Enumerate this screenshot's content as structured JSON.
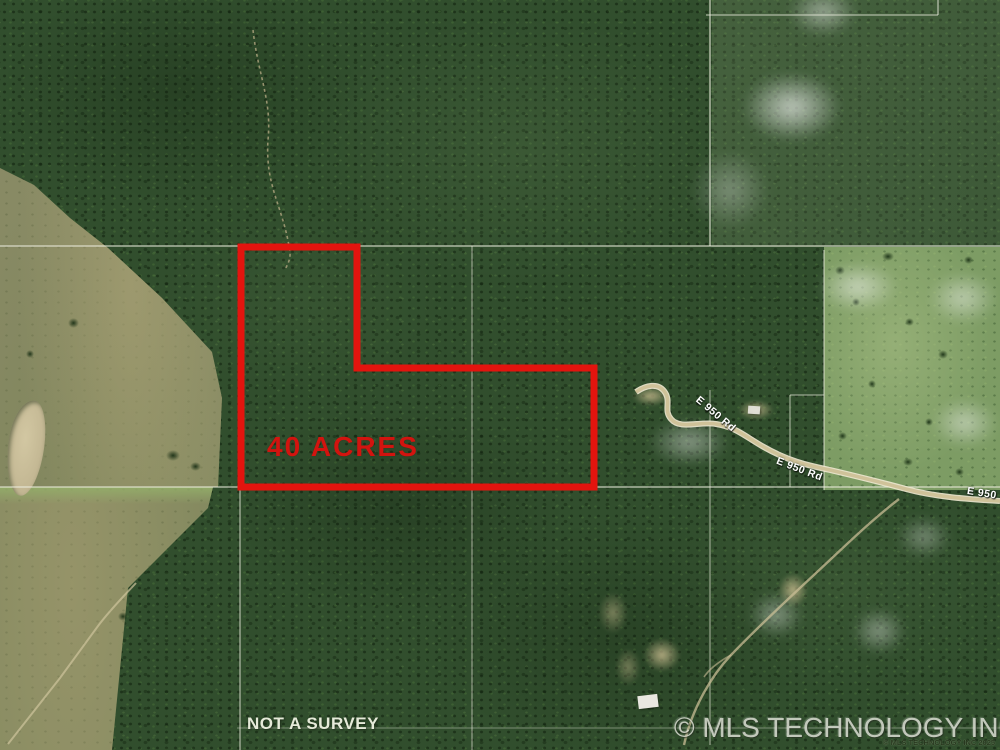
{
  "map": {
    "acreage_label": "40 ACRES",
    "disclaimer": "NOT A SURVEY",
    "watermark": "© MLS TECHNOLOGY INC 2025",
    "watermark_small": "© MLS TECHNOLOGY INC 2025",
    "road_labels": {
      "upper": "E 950 Rd",
      "mid": "E 950 Rd",
      "edge": "E 950"
    }
  },
  "colors": {
    "parcel-outline": "#e3140e",
    "acreage-text": "#d2140f",
    "disclaimer-text": "#e6ead9",
    "watermark-text": "#d7dacf",
    "boundary-line": "#eeeee0",
    "road-casing": "#efe9d2",
    "road-fill": "#cfc299",
    "forest-green": "#314e2d",
    "pasture-green": "#7d9c64",
    "field-olive": "#8a8b66",
    "pond-tan": "#c7bc9a"
  }
}
